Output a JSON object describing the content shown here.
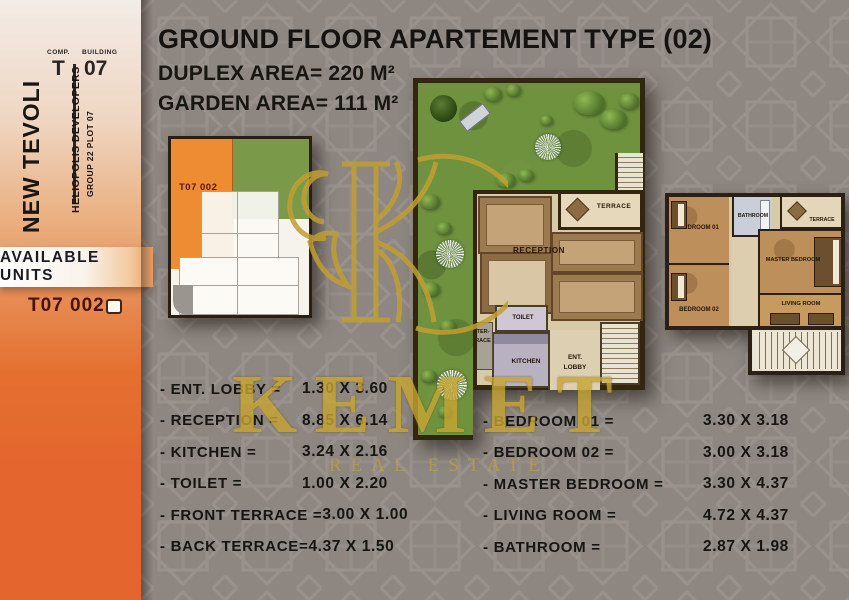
{
  "sidebar": {
    "comp_label": "COMP.",
    "comp_value": "T",
    "building_label": "BUILDING",
    "building_value": "07",
    "project_name": "NEW TEVOLI",
    "developer": "HELIOPOLIS DEVELOPERS",
    "plot": "GROUP 22 PLOT 07",
    "available_units_label": "AVAILABLE UNITS",
    "unit_code": "T07 002"
  },
  "header": {
    "title": "GROUND FLOOR APARTEMENT TYPE (02)",
    "duplex_area": "DUPLEX AREA= 220 M²",
    "garden_area": "GARDEN AREA= 111 M²"
  },
  "key_plan": {
    "unit_label": "T07 002"
  },
  "ground_plan": {
    "rooms": {
      "terrace": "TERRACE",
      "reception": "RECEPTION",
      "toilet": "TOILET",
      "kitchen": "KITCHEN",
      "ent_lobby_line1": "ENT.",
      "ent_lobby_line2": "LOBBY",
      "back_terrace_line1": "TER-",
      "back_terrace_line2": "RACE"
    }
  },
  "upper_plan": {
    "rooms": {
      "bedroom1": "BEDROOM 01",
      "bathroom": "BATHROOM",
      "terrace": "TERRACE",
      "master": "MASTER BEDROOM",
      "bedroom2": "BEDROOM 02",
      "living": "LIVING ROOM"
    }
  },
  "dimensions_left": [
    {
      "label": "- ENT. LOBBY =",
      "value": "1.30 X 3.60"
    },
    {
      "label": "- RECEPTION =",
      "value": "8.85 X 6.14"
    },
    {
      "label": "- KITCHEN =",
      "value": "3.24 X 2.16"
    },
    {
      "label": "- TOILET =",
      "value": "1.00 X 2.20"
    },
    {
      "label": "- FRONT TERRACE =",
      "value": "3.00 X 1.00"
    },
    {
      "label": "- BACK TERRACE=",
      "value": "4.37 X 1.50"
    }
  ],
  "dimensions_right": [
    {
      "label": "- BEDROOM  01  =",
      "value": "3.30 X 3.18"
    },
    {
      "label": "- BEDROOM  02  =",
      "value": "3.00 X 3.18"
    },
    {
      "label": "- MASTER  BEDROOM  =",
      "value": "3.30 X 4.37"
    },
    {
      "label": "- LIVING ROOM =",
      "value": "4.72 X 4.37"
    },
    {
      "label": "- BATHROOM  =",
      "value": "2.87 X 1.98"
    }
  ],
  "watermark": {
    "brand": "KEMET",
    "tagline": "REAL ESTATE"
  },
  "colors": {
    "accent_orange": "#e4662e",
    "brand_gold": "#c8a532",
    "background_gray": "#8d8681",
    "garden_green": "#6f923f",
    "unit_highlight": "#ee8c33"
  }
}
